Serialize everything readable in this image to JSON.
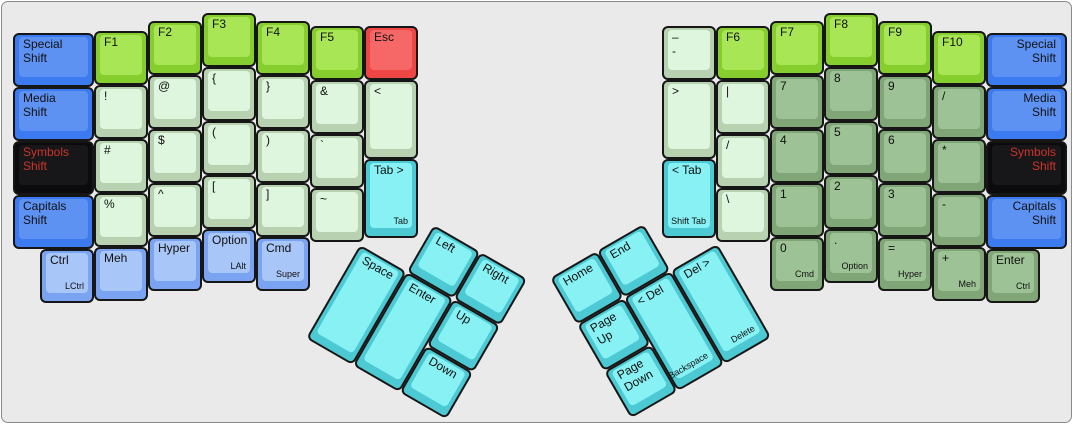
{
  "colors": {
    "surface": "#eaeaea",
    "frame-border": "#8a8a8a",
    "key-border": "#161616",
    "label": "#111111",
    "blue-base": "#3c7aef",
    "blue-top": "#5d92f3",
    "lblue-base": "#7aa4f2",
    "lblue-top": "#a9c6f8",
    "black-base": "#0b0b0d",
    "black-top": "#171719",
    "black-text": "#cc342b",
    "fkey-base": "#86ce2e",
    "fkey-top": "#a8e656",
    "pale-base": "#b7d1b1",
    "pale-top": "#ddf6dd",
    "num-base": "#80a577",
    "num-top": "#9dc295",
    "cyan-base": "#4cc9d3",
    "cyan-top": "#87f1f3",
    "red-base": "#ee4545",
    "red-top": "#f66868"
  },
  "layout": {
    "unit_px": 54
  },
  "keys": [
    {
      "name": "special-shift-left",
      "label": "Special\nShift",
      "x": 11,
      "y": 31,
      "w": 81,
      "color": "blue"
    },
    {
      "name": "media-shift-left",
      "label": "Media\nShift",
      "x": 11,
      "y": 85,
      "w": 81,
      "color": "blue"
    },
    {
      "name": "symbols-shift-left",
      "label": "Symbols\nShift",
      "x": 11,
      "y": 139,
      "w": 81,
      "color": "black"
    },
    {
      "name": "capitals-shift-left",
      "label": "Capitals\nShift",
      "x": 11,
      "y": 193,
      "w": 81,
      "color": "blue"
    },
    {
      "name": "f1",
      "label": "F1",
      "x": 92,
      "y": 29,
      "color": "fkey"
    },
    {
      "name": "exclamation",
      "label": "!",
      "x": 92,
      "y": 83,
      "color": "pale"
    },
    {
      "name": "hash",
      "label": "#",
      "x": 92,
      "y": 137,
      "color": "pale"
    },
    {
      "name": "percent",
      "label": "%",
      "x": 92,
      "y": 191,
      "color": "pale"
    },
    {
      "name": "f2",
      "label": "F2",
      "x": 146,
      "y": 19,
      "color": "fkey"
    },
    {
      "name": "at",
      "label": "@",
      "x": 146,
      "y": 73,
      "color": "pale"
    },
    {
      "name": "dollar",
      "label": "$",
      "x": 146,
      "y": 127,
      "color": "pale"
    },
    {
      "name": "caret",
      "label": "^",
      "x": 146,
      "y": 181,
      "color": "pale"
    },
    {
      "name": "f3",
      "label": "F3",
      "x": 200,
      "y": 11,
      "color": "fkey"
    },
    {
      "name": "open-brace",
      "label": "{",
      "x": 200,
      "y": 65,
      "color": "pale"
    },
    {
      "name": "open-paren",
      "label": "(",
      "x": 200,
      "y": 119,
      "color": "pale"
    },
    {
      "name": "open-bracket",
      "label": "[",
      "x": 200,
      "y": 173,
      "color": "pale"
    },
    {
      "name": "f4",
      "label": "F4",
      "x": 254,
      "y": 19,
      "color": "fkey"
    },
    {
      "name": "close-brace",
      "label": "}",
      "x": 254,
      "y": 73,
      "color": "pale"
    },
    {
      "name": "close-paren",
      "label": ")",
      "x": 254,
      "y": 127,
      "color": "pale"
    },
    {
      "name": "close-bracket",
      "label": "]",
      "x": 254,
      "y": 181,
      "color": "pale"
    },
    {
      "name": "f5",
      "label": "F5",
      "x": 308,
      "y": 24,
      "color": "fkey"
    },
    {
      "name": "ampersand",
      "label": "&",
      "x": 308,
      "y": 78,
      "color": "pale"
    },
    {
      "name": "backtick",
      "label": "`",
      "x": 308,
      "y": 132,
      "color": "pale"
    },
    {
      "name": "tilde",
      "label": "~",
      "x": 308,
      "y": 186,
      "color": "pale"
    },
    {
      "name": "esc",
      "label": "Esc",
      "x": 362,
      "y": 24,
      "color": "red"
    },
    {
      "name": "less-than",
      "label": "<",
      "x": 362,
      "y": 78,
      "h": 79,
      "color": "pale"
    },
    {
      "name": "tab-forward",
      "label": "Tab >",
      "sub": "Tab",
      "x": 362,
      "y": 157,
      "h": 79,
      "color": "cyan"
    },
    {
      "name": "ctrl-left",
      "label": "Ctrl",
      "sub": "LCtrl",
      "x": 38,
      "y": 247,
      "color": "lblue"
    },
    {
      "name": "meh-left",
      "label": "Meh",
      "x": 92,
      "y": 245,
      "color": "lblue"
    },
    {
      "name": "hyper-left",
      "label": "Hyper",
      "x": 146,
      "y": 235,
      "color": "lblue"
    },
    {
      "name": "option-left",
      "label": "Option",
      "sub": "LAlt",
      "x": 200,
      "y": 227,
      "color": "lblue"
    },
    {
      "name": "cmd-left",
      "label": "Cmd",
      "sub": "Super",
      "x": 254,
      "y": 235,
      "color": "lblue"
    },
    {
      "name": "dash",
      "label": "–\n-",
      "x": 660,
      "y": 24,
      "color": "pale"
    },
    {
      "name": "greater-than",
      "label": ">",
      "x": 660,
      "y": 78,
      "h": 79,
      "color": "pale"
    },
    {
      "name": "tab-back",
      "label": "< Tab",
      "sub": "Shift Tab",
      "x": 660,
      "y": 157,
      "h": 79,
      "color": "cyan"
    },
    {
      "name": "f6",
      "label": "F6",
      "x": 714,
      "y": 24,
      "color": "fkey"
    },
    {
      "name": "pipe",
      "label": "|",
      "x": 714,
      "y": 78,
      "color": "pale"
    },
    {
      "name": "slash",
      "label": "/",
      "x": 714,
      "y": 132,
      "color": "pale"
    },
    {
      "name": "backslash",
      "label": "\\",
      "x": 714,
      "y": 186,
      "color": "pale"
    },
    {
      "name": "f7",
      "label": "F7",
      "x": 768,
      "y": 19,
      "color": "fkey"
    },
    {
      "name": "num-7",
      "label": "7",
      "x": 768,
      "y": 73,
      "color": "num"
    },
    {
      "name": "num-4",
      "label": "4",
      "x": 768,
      "y": 127,
      "color": "num"
    },
    {
      "name": "num-1",
      "label": "1",
      "x": 768,
      "y": 181,
      "color": "num"
    },
    {
      "name": "num-0",
      "label": "0",
      "sub": "Cmd",
      "x": 768,
      "y": 235,
      "color": "num"
    },
    {
      "name": "f8",
      "label": "F8",
      "x": 822,
      "y": 11,
      "color": "fkey"
    },
    {
      "name": "num-8",
      "label": "8",
      "x": 822,
      "y": 65,
      "color": "num"
    },
    {
      "name": "num-5",
      "label": "5",
      "x": 822,
      "y": 119,
      "color": "num"
    },
    {
      "name": "num-2",
      "label": "2",
      "x": 822,
      "y": 173,
      "color": "num"
    },
    {
      "name": "num-period",
      "label": ".",
      "sub": "Option",
      "x": 822,
      "y": 227,
      "color": "num"
    },
    {
      "name": "f9",
      "label": "F9",
      "x": 876,
      "y": 19,
      "color": "fkey"
    },
    {
      "name": "num-9",
      "label": "9",
      "x": 876,
      "y": 73,
      "color": "num"
    },
    {
      "name": "num-6",
      "label": "6",
      "x": 876,
      "y": 127,
      "color": "num"
    },
    {
      "name": "num-3",
      "label": "3",
      "x": 876,
      "y": 181,
      "color": "num"
    },
    {
      "name": "num-equals",
      "label": "=",
      "sub": "Hyper",
      "x": 876,
      "y": 235,
      "color": "num"
    },
    {
      "name": "f10",
      "label": "F10",
      "x": 930,
      "y": 29,
      "color": "fkey"
    },
    {
      "name": "num-slash",
      "label": "/",
      "x": 930,
      "y": 83,
      "color": "num"
    },
    {
      "name": "num-asterisk",
      "label": "*",
      "x": 930,
      "y": 137,
      "color": "num"
    },
    {
      "name": "num-minus",
      "label": "-",
      "x": 930,
      "y": 191,
      "color": "num"
    },
    {
      "name": "num-plus",
      "label": "+",
      "sub": "Meh",
      "x": 930,
      "y": 245,
      "color": "num"
    },
    {
      "name": "special-shift-right",
      "label": "Special\nShift",
      "x": 984,
      "y": 31,
      "w": 81,
      "color": "blue",
      "align": "right"
    },
    {
      "name": "media-shift-right",
      "label": "Media\nShift",
      "x": 984,
      "y": 85,
      "w": 81,
      "color": "blue",
      "align": "right"
    },
    {
      "name": "symbols-shift-right",
      "label": "Symbols\nShift",
      "x": 984,
      "y": 139,
      "w": 81,
      "color": "black",
      "align": "right"
    },
    {
      "name": "capitals-shift-right",
      "label": "Capitals\nShift",
      "x": 984,
      "y": 193,
      "w": 81,
      "color": "blue",
      "align": "right"
    },
    {
      "name": "enter-right",
      "label": "Enter",
      "sub": "Ctrl",
      "x": 984,
      "y": 247,
      "color": "num"
    }
  ],
  "thumb_left": {
    "origin_x": 385,
    "origin_y": 196,
    "rotation_deg": 30,
    "keys": [
      {
        "name": "left-arrow",
        "label": "Left",
        "x": 54,
        "y": 0,
        "color": "cyan"
      },
      {
        "name": "right-arrow",
        "label": "Right",
        "x": 108,
        "y": 0,
        "color": "cyan"
      },
      {
        "name": "space",
        "label": "Space",
        "x": 0,
        "y": 54,
        "h": 108,
        "color": "cyan"
      },
      {
        "name": "enter-thumb",
        "label": "Enter",
        "x": 54,
        "y": 54,
        "h": 108,
        "color": "cyan"
      },
      {
        "name": "up-arrow",
        "label": "Up",
        "x": 108,
        "y": 54,
        "color": "cyan"
      },
      {
        "name": "down-arrow",
        "label": "Down",
        "x": 108,
        "y": 108,
        "color": "cyan"
      }
    ]
  },
  "thumb_right": {
    "origin_x": 548,
    "origin_y": 276,
    "rotation_deg": -30,
    "keys": [
      {
        "name": "home",
        "label": "Home",
        "x": 0,
        "y": 0,
        "color": "cyan"
      },
      {
        "name": "end",
        "label": "End",
        "x": 54,
        "y": 0,
        "color": "cyan"
      },
      {
        "name": "page-up",
        "label": "Page\nUp",
        "x": 0,
        "y": 54,
        "color": "cyan"
      },
      {
        "name": "del-back",
        "label": "< Del",
        "sub": "Backspace",
        "x": 54,
        "y": 54,
        "h": 108,
        "color": "cyan"
      },
      {
        "name": "del-forward",
        "label": "Del >",
        "sub": "Delete",
        "x": 108,
        "y": 54,
        "h": 108,
        "color": "cyan"
      },
      {
        "name": "page-down",
        "label": "Page\nDown",
        "x": 0,
        "y": 108,
        "color": "cyan"
      }
    ]
  }
}
